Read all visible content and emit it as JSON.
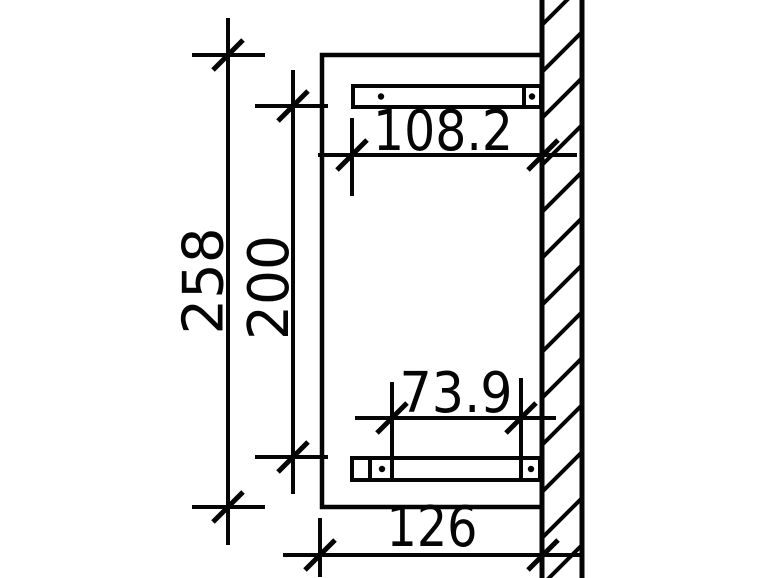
{
  "drawing": {
    "background_color": "#ffffff",
    "line_color": "#050505",
    "view": "side-elevation-with-wall-section",
    "dimensions": {
      "overall_height": {
        "label": "258",
        "orientation": "vertical"
      },
      "inner_height": {
        "label": "200",
        "orientation": "vertical"
      },
      "upper_width": {
        "label": "108.2",
        "orientation": "horizontal"
      },
      "lower_inner_width": {
        "label": "73.9",
        "orientation": "horizontal"
      },
      "lower_width": {
        "label": "126",
        "orientation": "horizontal"
      }
    }
  }
}
